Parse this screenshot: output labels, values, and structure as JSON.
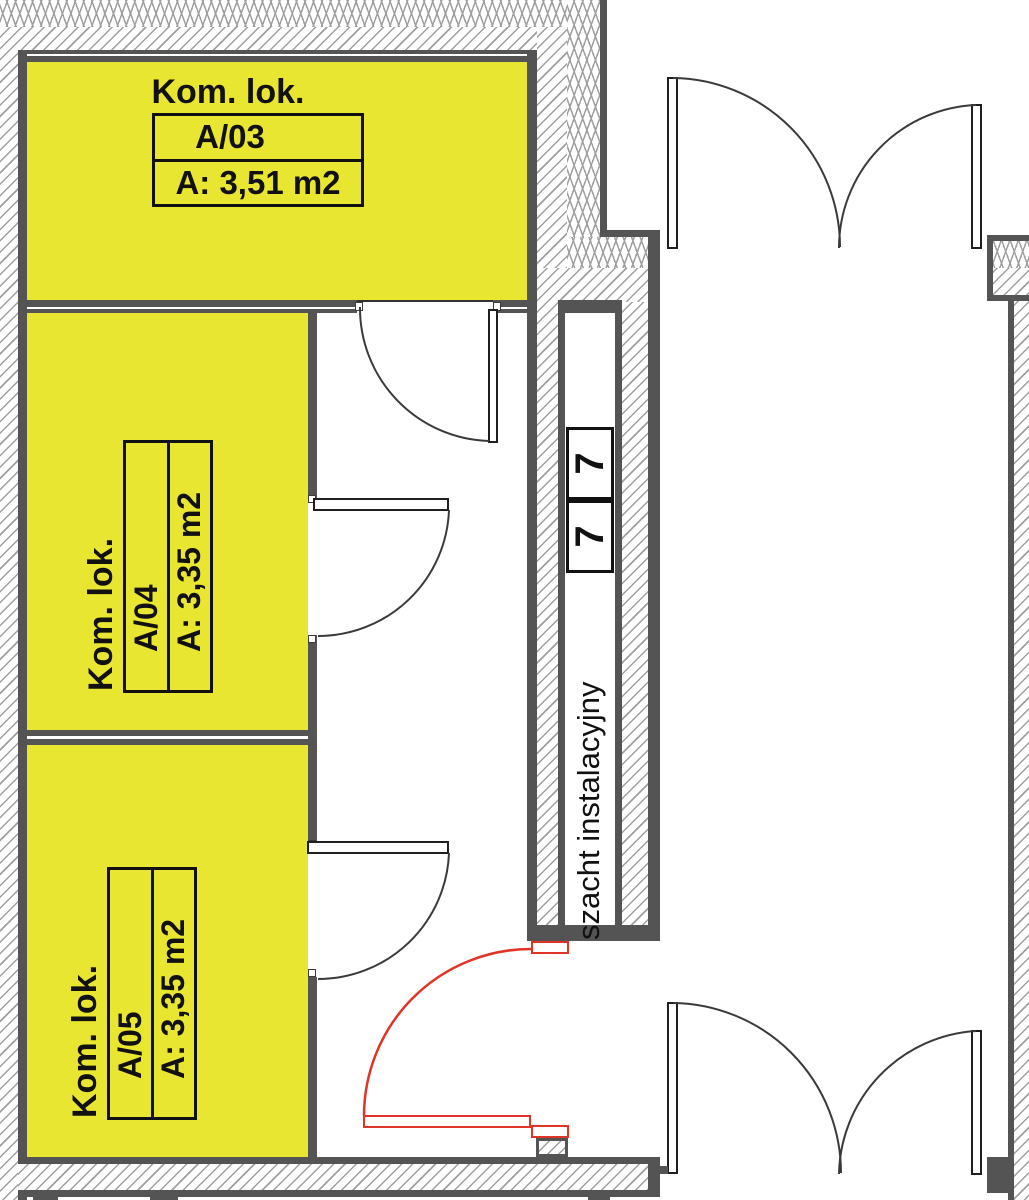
{
  "floorplan": {
    "rooms": [
      {
        "name_label": "Kom. lok.",
        "id": "A/03",
        "area": "A: 3,51 m2"
      },
      {
        "name_label": "Kom. lok.",
        "id": "A/04",
        "area": "A: 3,35 m2"
      },
      {
        "name_label": "Kom. lok.",
        "id": "A/05",
        "area": "A: 3,35 m2"
      }
    ],
    "shaft": {
      "label": "szacht instalacyjny",
      "compartments": [
        "7",
        "7"
      ]
    },
    "colors": {
      "room_fill": "#e9e631",
      "wall": "#545454",
      "hatch_line": "#9f9f9f",
      "door_red": "#df3426",
      "text": "#111111"
    }
  }
}
